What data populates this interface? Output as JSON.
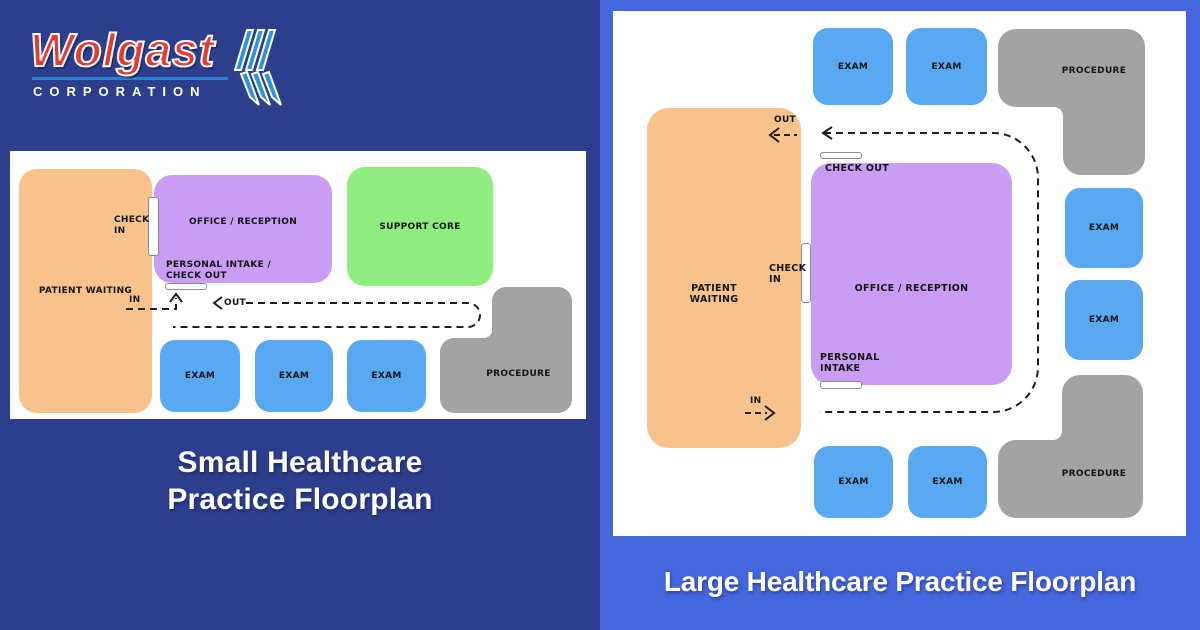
{
  "logo": {
    "brand": "Wolgast",
    "subtitle": "CORPORATION"
  },
  "colors": {
    "left_background": "#2d3e8c",
    "right_background": "#4566dd",
    "brand_red": "#e33b30",
    "brand_blue": "#2e7ecf",
    "room_patient_waiting": "#f7c28c",
    "room_office_reception": "#c89df3",
    "room_support_core": "#8eed7e",
    "room_exam": "#58a9f1",
    "room_procedure": "#a4a3a2",
    "path_dash": "#1f1f1f"
  },
  "small_plan": {
    "title": "Small Healthcare\nPractice Floorplan",
    "rooms": {
      "patient_waiting": "PATIENT WAITING",
      "office_reception": "OFFICE / RECEPTION",
      "support_core": "SUPPORT CORE",
      "exam_1": "EXAM",
      "exam_2": "EXAM",
      "exam_3": "EXAM",
      "procedure": "PROCEDURE"
    },
    "annotations": {
      "check_in": "CHECK\nIN",
      "personal_intake": "PERSONAL INTAKE /\nCHECK OUT",
      "flow_in": "IN",
      "flow_out": "OUT"
    }
  },
  "large_plan": {
    "title": "Large Healthcare Practice Floorplan",
    "rooms": {
      "patient_waiting": "PATIENT\nWAITING",
      "office_reception": "OFFICE / RECEPTION",
      "exam_top_1": "EXAM",
      "exam_top_2": "EXAM",
      "exam_right_1": "EXAM",
      "exam_right_2": "EXAM",
      "exam_bottom_1": "EXAM",
      "exam_bottom_2": "EXAM",
      "procedure_top": "PROCEDURE",
      "procedure_bottom": "PROCEDURE"
    },
    "annotations": {
      "check_in": "CHECK\nIN",
      "check_out": "CHECK OUT",
      "personal_intake": "PERSONAL\nINTAKE",
      "flow_in": "IN",
      "flow_out": "OUT"
    }
  }
}
